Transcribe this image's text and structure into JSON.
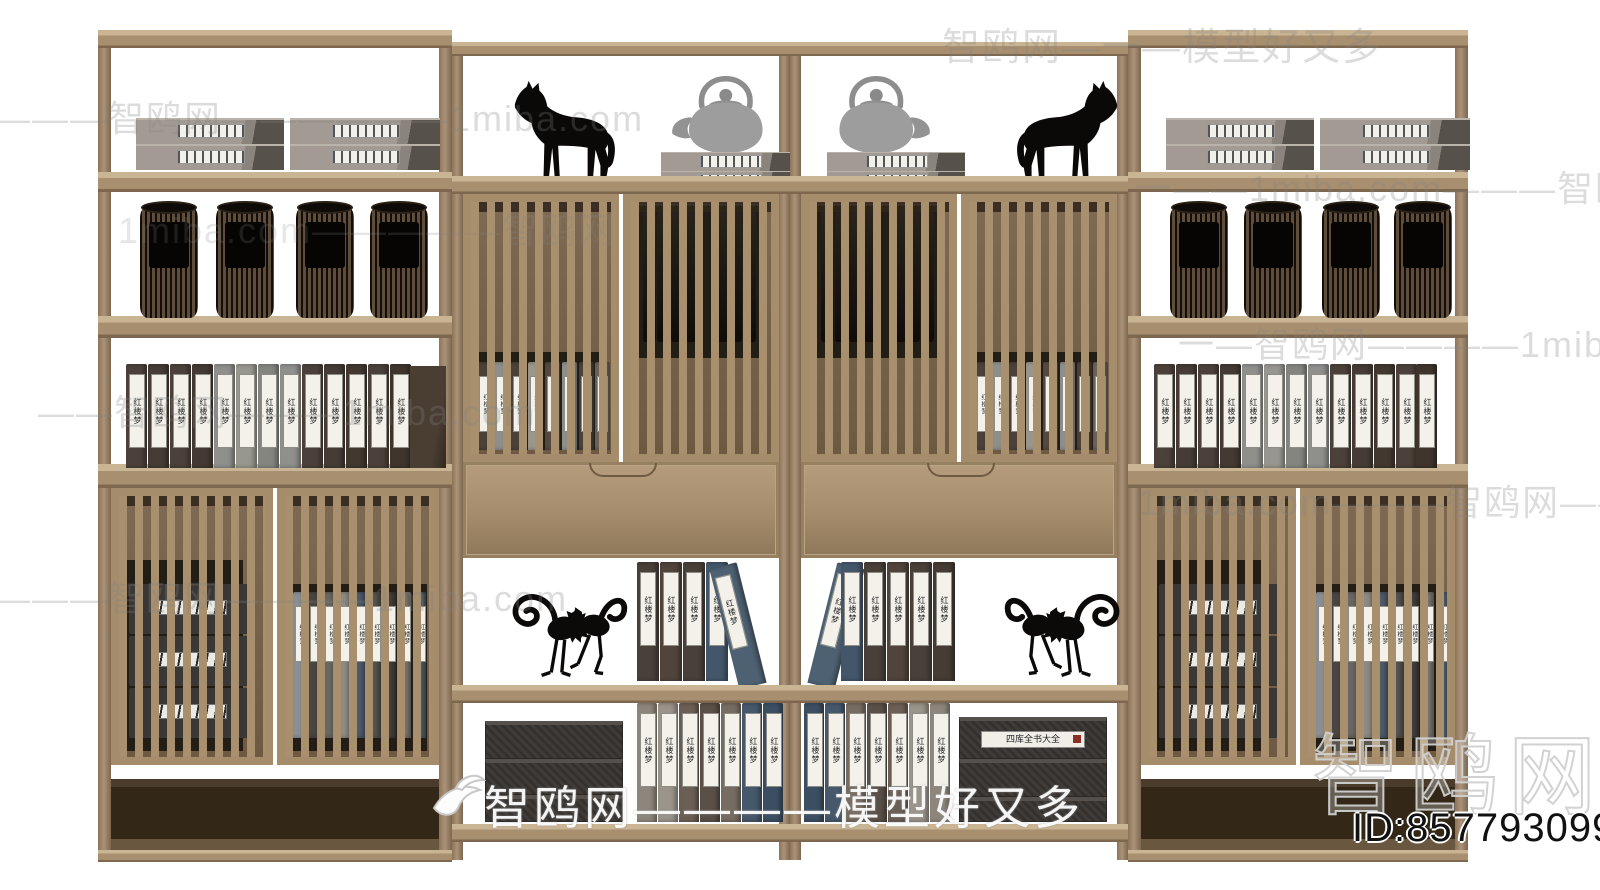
{
  "meta": {
    "site_name": "智鸥网",
    "model_id": "857793099"
  },
  "watermarks": {
    "row_a": "————智鸥网——————1miba.com",
    "row_b": "智鸥网—一—模型好又多",
    "row_c": "一——1miba.com———智鸥网——",
    "row_d": "1miba.com—————智鸥网",
    "row_e": "一—智鸥网————1miba.com",
    "row_f": "——智鸥网———1miba.com",
    "row_g": "1miba.com———智鸥网————",
    "row_h": "———智鸥网————1miba.com",
    "row_i": "智鸥网————模型好又多",
    "big_logo": "智鸥网",
    "id_text": "ID:857793099"
  },
  "labels": {
    "book_spine": "红楼梦",
    "box_set": "四库全书大全"
  },
  "colors": {
    "wood_face": "#a68e71",
    "wood_light": "#c9b494",
    "wood_dark": "#7c674f",
    "interior_dark": "#241d16",
    "box_gray": "#a39b93",
    "statue_black": "#0c0a08",
    "teapot_gray": "#9d9d9d",
    "watermark_gray": "#c9c9c9",
    "background": "#ffffff"
  },
  "units": {
    "u1": {
      "canisters": [
        {
          "x": 42
        },
        {
          "x": 118
        },
        {
          "x": 198
        },
        {
          "x": 272
        }
      ],
      "books": [
        {
          "x": 28,
          "c": "#4c413a"
        },
        {
          "x": 50,
          "c": "#463c35"
        },
        {
          "x": 72,
          "c": "#4c413a"
        },
        {
          "x": 94,
          "c": "#443a33"
        },
        {
          "x": 116,
          "c": "#8f8f8c"
        },
        {
          "x": 138,
          "c": "#97978f"
        },
        {
          "x": 160,
          "c": "#858580"
        },
        {
          "x": 182,
          "c": "#8f8f8c"
        },
        {
          "x": 204,
          "c": "#4c413a"
        },
        {
          "x": 226,
          "c": "#463c35"
        },
        {
          "x": 248,
          "c": "#42382f"
        },
        {
          "x": 270,
          "c": "#4c413a"
        },
        {
          "x": 292,
          "c": "#3f352d"
        }
      ],
      "door_boxes": [
        {
          "y": 88
        },
        {
          "y": 140
        },
        {
          "y": 192
        }
      ],
      "door_books": [
        {
          "x": 8,
          "c": "#8a8f93"
        },
        {
          "x": 23,
          "c": "#4a4541"
        },
        {
          "x": 38,
          "c": "#6a6662"
        },
        {
          "x": 53,
          "c": "#8f8a84"
        },
        {
          "x": 68,
          "c": "#4d5a68"
        },
        {
          "x": 83,
          "c": "#57544f"
        },
        {
          "x": 98,
          "c": "#44403c"
        },
        {
          "x": 113,
          "c": "#7d7873"
        },
        {
          "x": 128,
          "c": "#4f5e6c"
        }
      ]
    },
    "u2": {
      "cab_books": [
        {
          "x": 6,
          "c": "#4b4139"
        },
        {
          "x": 23,
          "c": "#8e8e8b"
        },
        {
          "x": 40,
          "c": "#4b4139"
        },
        {
          "x": 57,
          "c": "#9b958c"
        },
        {
          "x": 74,
          "c": "#55493f"
        },
        {
          "x": 91,
          "c": "#8e8e8b"
        },
        {
          "x": 108,
          "c": "#4b4139"
        },
        {
          "x": 124,
          "c": "#6b6159"
        }
      ],
      "cab_canisters": [
        {
          "x": 12
        },
        {
          "x": 26
        },
        {
          "x": 40
        },
        {
          "x": 54
        },
        {
          "x": 84
        },
        {
          "x": 98
        },
        {
          "x": 112
        }
      ],
      "shelf_books": [
        {
          "x": 174,
          "c": "#4a403a"
        },
        {
          "x": 197,
          "c": "#50443c"
        },
        {
          "x": 220,
          "c": "#4a403a"
        },
        {
          "x": 243,
          "c": "#44566a"
        },
        {
          "x": 276,
          "c": "#4e6172",
          "lean": -14,
          "w": 28,
          "h": 124
        }
      ],
      "bottom_books": [
        {
          "x": 174,
          "c": "#8d867c"
        },
        {
          "x": 195,
          "c": "#9a948b"
        },
        {
          "x": 216,
          "c": "#6b5f55"
        },
        {
          "x": 237,
          "c": "#5a5048"
        },
        {
          "x": 258,
          "c": "#776c61"
        },
        {
          "x": 279,
          "c": "#46586b"
        },
        {
          "x": 300,
          "c": "#3c4f62"
        }
      ],
      "bottom_boxes": [
        {
          "y": 18,
          "h": 38
        },
        {
          "y": 56,
          "h": 36
        },
        {
          "y": 92,
          "h": 27
        }
      ]
    },
    "u3": {
      "cab_books": [
        {
          "x": 6,
          "c": "#4b4139"
        },
        {
          "x": 23,
          "c": "#8e8e8b"
        },
        {
          "x": 40,
          "c": "#4b4139"
        },
        {
          "x": 57,
          "c": "#9b958c"
        },
        {
          "x": 74,
          "c": "#55493f"
        },
        {
          "x": 91,
          "c": "#8e8e8b"
        },
        {
          "x": 108,
          "c": "#4b4139"
        },
        {
          "x": 124,
          "c": "#6b6159"
        }
      ],
      "cab_canisters": [
        {
          "x": 12
        },
        {
          "x": 26
        },
        {
          "x": 40
        },
        {
          "x": 54
        },
        {
          "x": 84
        },
        {
          "x": 98
        },
        {
          "x": 112
        }
      ],
      "shelf_books": [
        {
          "x": 6,
          "c": "#4e6172",
          "lean": 14,
          "w": 28,
          "h": 124
        },
        {
          "x": 40,
          "c": "#44566a"
        },
        {
          "x": 63,
          "c": "#4a403a"
        },
        {
          "x": 86,
          "c": "#50443c"
        },
        {
          "x": 109,
          "c": "#4a403a"
        },
        {
          "x": 132,
          "c": "#463c35"
        }
      ],
      "bottom_books": [
        {
          "x": 3,
          "c": "#3c4f62"
        },
        {
          "x": 24,
          "c": "#46586b"
        },
        {
          "x": 45,
          "c": "#776c61"
        },
        {
          "x": 66,
          "c": "#5a5048"
        },
        {
          "x": 87,
          "c": "#6b5f55"
        },
        {
          "x": 108,
          "c": "#9a948b"
        },
        {
          "x": 129,
          "c": "#8d867c"
        }
      ],
      "bottom_boxes": [
        {
          "y": 14,
          "h": 42
        },
        {
          "y": 56,
          "h": 38
        },
        {
          "y": 94,
          "h": 25
        }
      ]
    },
    "u4": {
      "canisters": [
        {
          "x": 42
        },
        {
          "x": 116
        },
        {
          "x": 194
        },
        {
          "x": 266
        }
      ],
      "books": [
        {
          "x": 26,
          "c": "#4c413a"
        },
        {
          "x": 48,
          "c": "#463c35"
        },
        {
          "x": 70,
          "c": "#4c413a"
        },
        {
          "x": 92,
          "c": "#443a33"
        },
        {
          "x": 114,
          "c": "#8f8f8c"
        },
        {
          "x": 136,
          "c": "#97978f"
        },
        {
          "x": 158,
          "c": "#858580"
        },
        {
          "x": 180,
          "c": "#8f8f8c"
        },
        {
          "x": 202,
          "c": "#4c413a"
        },
        {
          "x": 224,
          "c": "#463c35"
        },
        {
          "x": 246,
          "c": "#42382f"
        },
        {
          "x": 268,
          "c": "#4c413a"
        },
        {
          "x": 288,
          "c": "#3f352d"
        }
      ],
      "door_boxes": [
        {
          "y": 88
        },
        {
          "y": 140
        },
        {
          "y": 192
        }
      ],
      "door_books": [
        {
          "x": 8,
          "c": "#8a8f93"
        },
        {
          "x": 23,
          "c": "#4a4541"
        },
        {
          "x": 38,
          "c": "#6a6662"
        },
        {
          "x": 53,
          "c": "#8f8a84"
        },
        {
          "x": 68,
          "c": "#4d5a68"
        },
        {
          "x": 83,
          "c": "#57544f"
        },
        {
          "x": 98,
          "c": "#44403c"
        },
        {
          "x": 113,
          "c": "#7d7873"
        },
        {
          "x": 128,
          "c": "#4f5e6c"
        }
      ]
    }
  }
}
